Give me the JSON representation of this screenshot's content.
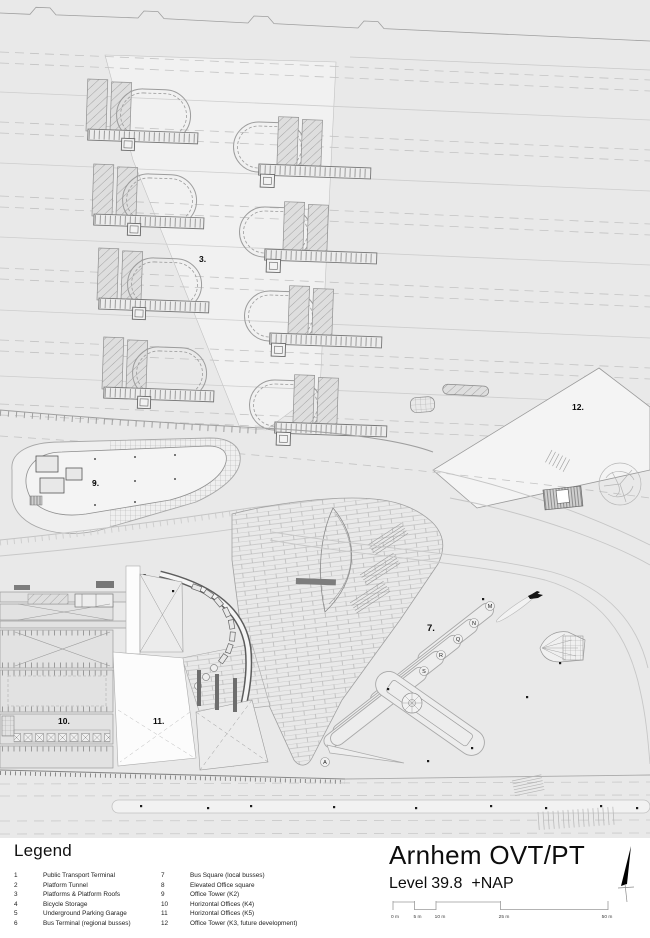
{
  "title_block": {
    "project": "Arnhem OVT/PT",
    "level_label": "Level",
    "level_value": "39.8",
    "datum": "+NAP"
  },
  "legend": {
    "heading": "Legend",
    "items": [
      {
        "num": "1",
        "label": "Public Transport Terminal"
      },
      {
        "num": "2",
        "label": "Platform Tunnel"
      },
      {
        "num": "3",
        "label": "Platforms & Platform Roofs"
      },
      {
        "num": "4",
        "label": "Bicycle Storage"
      },
      {
        "num": "5",
        "label": "Underground Parking Garage"
      },
      {
        "num": "6",
        "label": "Bus Terminal (regional busses)"
      },
      {
        "num": "7",
        "label": "Bus Square (local busses)"
      },
      {
        "num": "8",
        "label": "Elevated Office square"
      },
      {
        "num": "9",
        "label": "Office Tower (K2)"
      },
      {
        "num": "10",
        "label": "Horizontal Offices (K4)"
      },
      {
        "num": "11",
        "label": "Horizontal Offices (K5)"
      },
      {
        "num": "12",
        "label": "Office Tower (K3, future development)"
      }
    ]
  },
  "scale_bar": {
    "ticks": [
      "0 m",
      "5 m",
      "10 m",
      "25 m",
      "50 m"
    ]
  },
  "plan_labels": {
    "p3": "3.",
    "p7": "7.",
    "p8": "8.",
    "p9": "9.",
    "p10": "10.",
    "p11": "11.",
    "p12": "12."
  },
  "bus_stops": {
    "m": "M",
    "n": "N",
    "q": "Q",
    "r": "R",
    "s": "S",
    "a": "A"
  },
  "colors": {
    "drawing_background": "#e9e9e9",
    "station_zone": "#f1f1f1",
    "paper": "#ffffff",
    "line_gray": "#9a9a9a",
    "label_black": "#111111"
  }
}
